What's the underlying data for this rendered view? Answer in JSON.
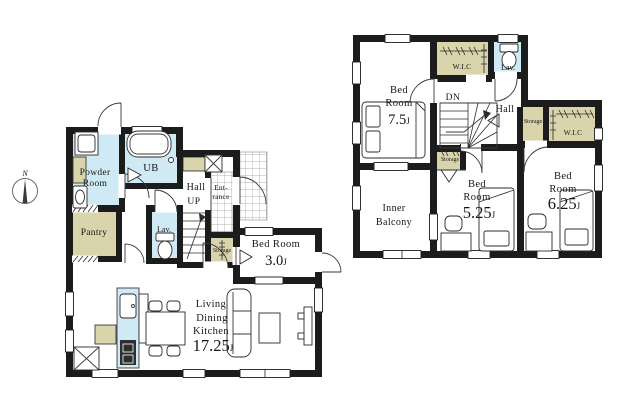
{
  "canvas": {
    "width": 629,
    "height": 403,
    "background": "#ffffff"
  },
  "colors": {
    "wall": "#1c1c1c",
    "water_blue": "#cfe9f5",
    "tan": "#d9d4ab",
    "tile_line": "#9a9a9a",
    "line": "#2b2b2b"
  },
  "compass": {
    "north_label": "N"
  },
  "floor1": {
    "powder_room": {
      "line1": "Powder",
      "line2": "Room"
    },
    "bath": {
      "label": "UB"
    },
    "hall": {
      "label": "Hall"
    },
    "stairs": {
      "label": "UP"
    },
    "entrance": {
      "line1": "Ent-",
      "line2": "rance"
    },
    "pantry": {
      "label": "Pantry"
    },
    "lavatory": {
      "label": "Lav."
    },
    "storage": {
      "label": "Storage"
    },
    "bedroom": {
      "name": "Bed Room",
      "size": "3.0",
      "unit": "J"
    },
    "ldk": {
      "line1": "Living",
      "line2": "Dining",
      "line3": "Kitchen",
      "size": "17.25",
      "unit": "J"
    }
  },
  "floor2": {
    "bedroom_main": {
      "line1": "Bed",
      "line2": "Room",
      "size": "7.5",
      "unit": "J"
    },
    "wic_top": {
      "label": "W.I.C"
    },
    "lavatory": {
      "label": "Lav."
    },
    "stairs": {
      "label": "DN"
    },
    "hall": {
      "label": "Hall"
    },
    "storage_hall": {
      "label": "Storage"
    },
    "wic_right": {
      "label": "W.I.C"
    },
    "storage_mid": {
      "label": "Storage"
    },
    "inner_balcony": {
      "line1": "Inner",
      "line2": "Balcony"
    },
    "bedroom_mid": {
      "line1": "Bed",
      "line2": "Room",
      "size": "5.25",
      "unit": "J"
    },
    "bedroom_right": {
      "line1": "Bed",
      "line2": "Room",
      "size": "6.25",
      "unit": "J"
    }
  }
}
